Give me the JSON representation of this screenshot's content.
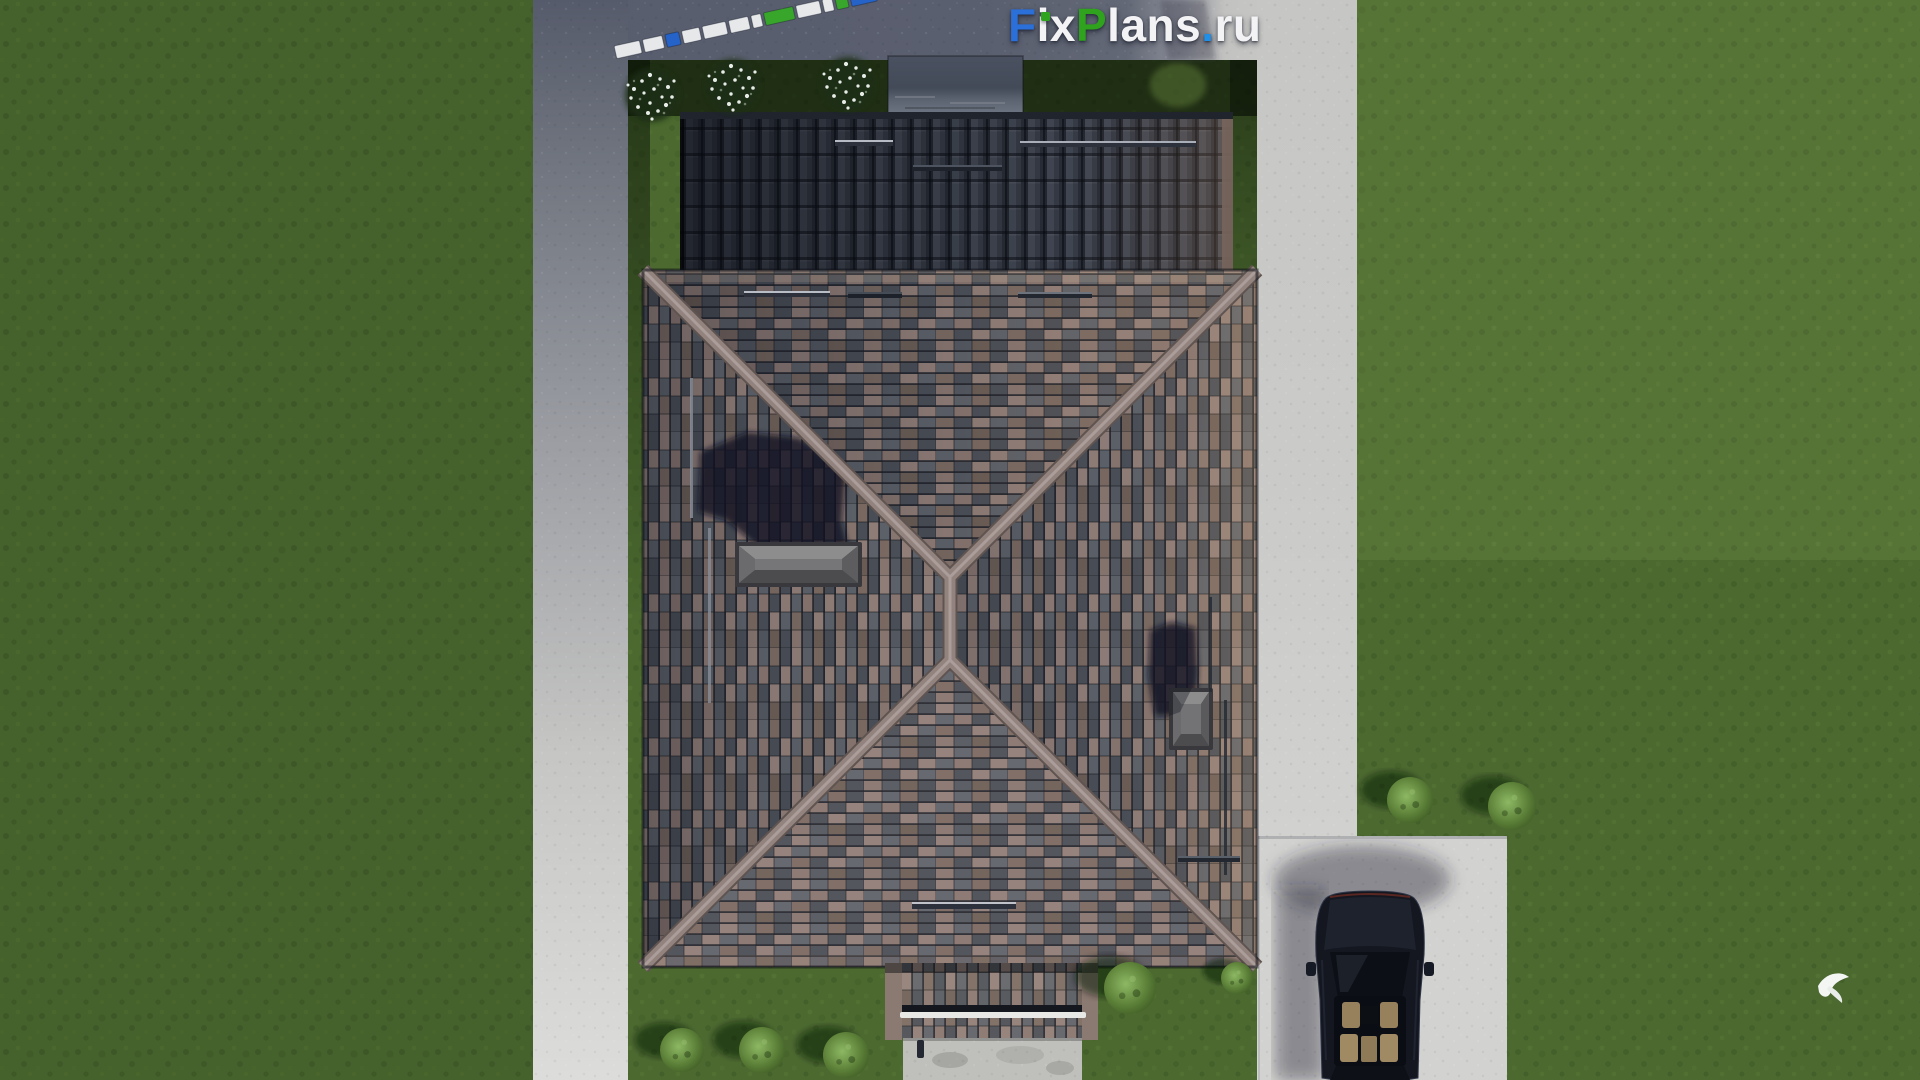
{
  "watermark": {
    "segments": [
      {
        "text": "F",
        "color": "#2b6fd8"
      },
      {
        "text": "ix",
        "color": "#f3f3f5"
      },
      {
        "text": "P",
        "color": "#2fa31d"
      },
      {
        "text": "lans",
        "color": "#f3f3f5"
      },
      {
        "text": ".",
        "color": "#1f8fe8"
      },
      {
        "text": "ru",
        "color": "#f3f3f5"
      }
    ]
  },
  "scene": {
    "type": "aerial-3d-render",
    "subject": "top-down view of a single-family house with hip tile roof, yard, paths, driveway and parked car",
    "elements": [
      "main hip roof with mixed brown-grey barrel tiles and X ridge lines",
      "dark shaded upper garage roof with vertical tiles",
      "flat dark rooftop box above garage roof",
      "two grey roof skylights",
      "two dark chimney shadows on roof slopes",
      "snow guard bars on roof",
      "roof ladder / pipe lines",
      "porch roof with white gutter at bottom",
      "concrete paths left, top and right",
      "driveway pad with dark parked car",
      "lawn with round green bushes",
      "three white flowering shrubs in shaded yard",
      "fence of small colored panels top-left",
      "white flying bird over right lawn"
    ],
    "fence_panels": [
      "white",
      "white",
      "blue",
      "white",
      "white",
      "white",
      "white",
      "green",
      "white",
      "white",
      "green",
      "blue"
    ],
    "palette": {
      "grass": "#4c6a30",
      "grass_shaded": "#1e2f16",
      "concrete": "#cbcbc9",
      "concrete_shadow": "#565b6b",
      "roof_tile_mauve": "#94817b",
      "roof_tile_slate": "#5f646c",
      "roof_tile_brown": "#7d6c64",
      "roof_tile_dark": "#4b5059",
      "ridge": "#93837f",
      "garage_roof": "#3a3f4a",
      "skylight": "#767678",
      "car_body": "#14171f",
      "car_seats": "#a08a64",
      "bush": "#6f9c49",
      "flowers": "#e8ece8",
      "fence_white": "#e6e8ea",
      "fence_blue": "#2563c8",
      "fence_green": "#38a62a",
      "gutter_white": "#e8e8e6"
    }
  }
}
